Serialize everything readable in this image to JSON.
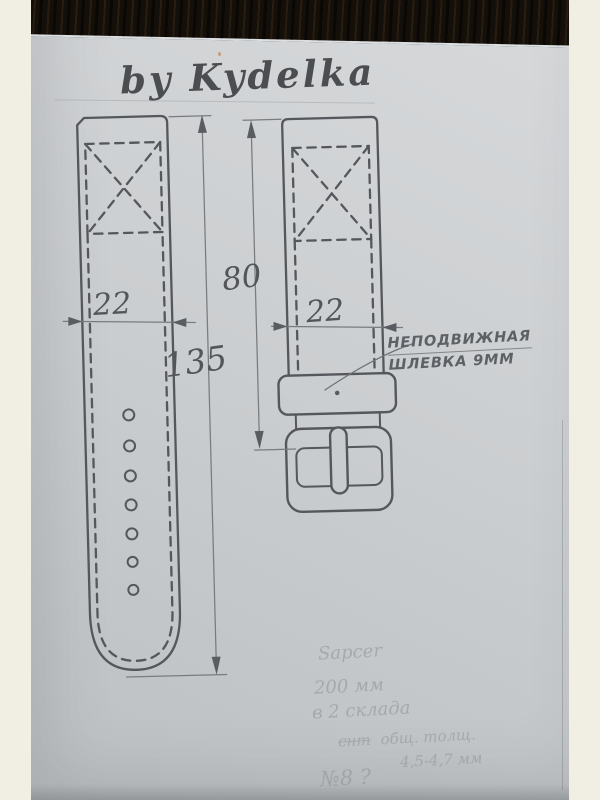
{
  "title": "by Kydelka",
  "diagram": {
    "left_strap": {
      "description": "long tail piece of watch strap with stitched cross pad, edge stitching and 7 adjustment holes",
      "width_mm": "22",
      "length_mm": "135",
      "holes": 7
    },
    "right_strap": {
      "description": "buckle piece of watch strap with stitched cross pad, fixed keeper loop and buckle with prong",
      "length_mm": "80",
      "width_mm": "22"
    },
    "annotation": {
      "line1": "НЕПОДВИЖНАЯ",
      "line2": "ШЛЕВКА 9ММ"
    }
  },
  "notes": {
    "line1": "Sapcer",
    "line2": "200 мм",
    "line3": "в 2 склада",
    "line4_strike": "снт",
    "line4": "общ. толщ.",
    "line5": "4,5-4,7 мм",
    "line6": "№8 ?"
  },
  "colors": {
    "paper": "#c9ccce",
    "pencil": "#55575c",
    "dimension_line": "#787b80",
    "wood_surface": "#150f09",
    "mat_border": "#f1efe3",
    "faint_note": "#8f959a"
  }
}
